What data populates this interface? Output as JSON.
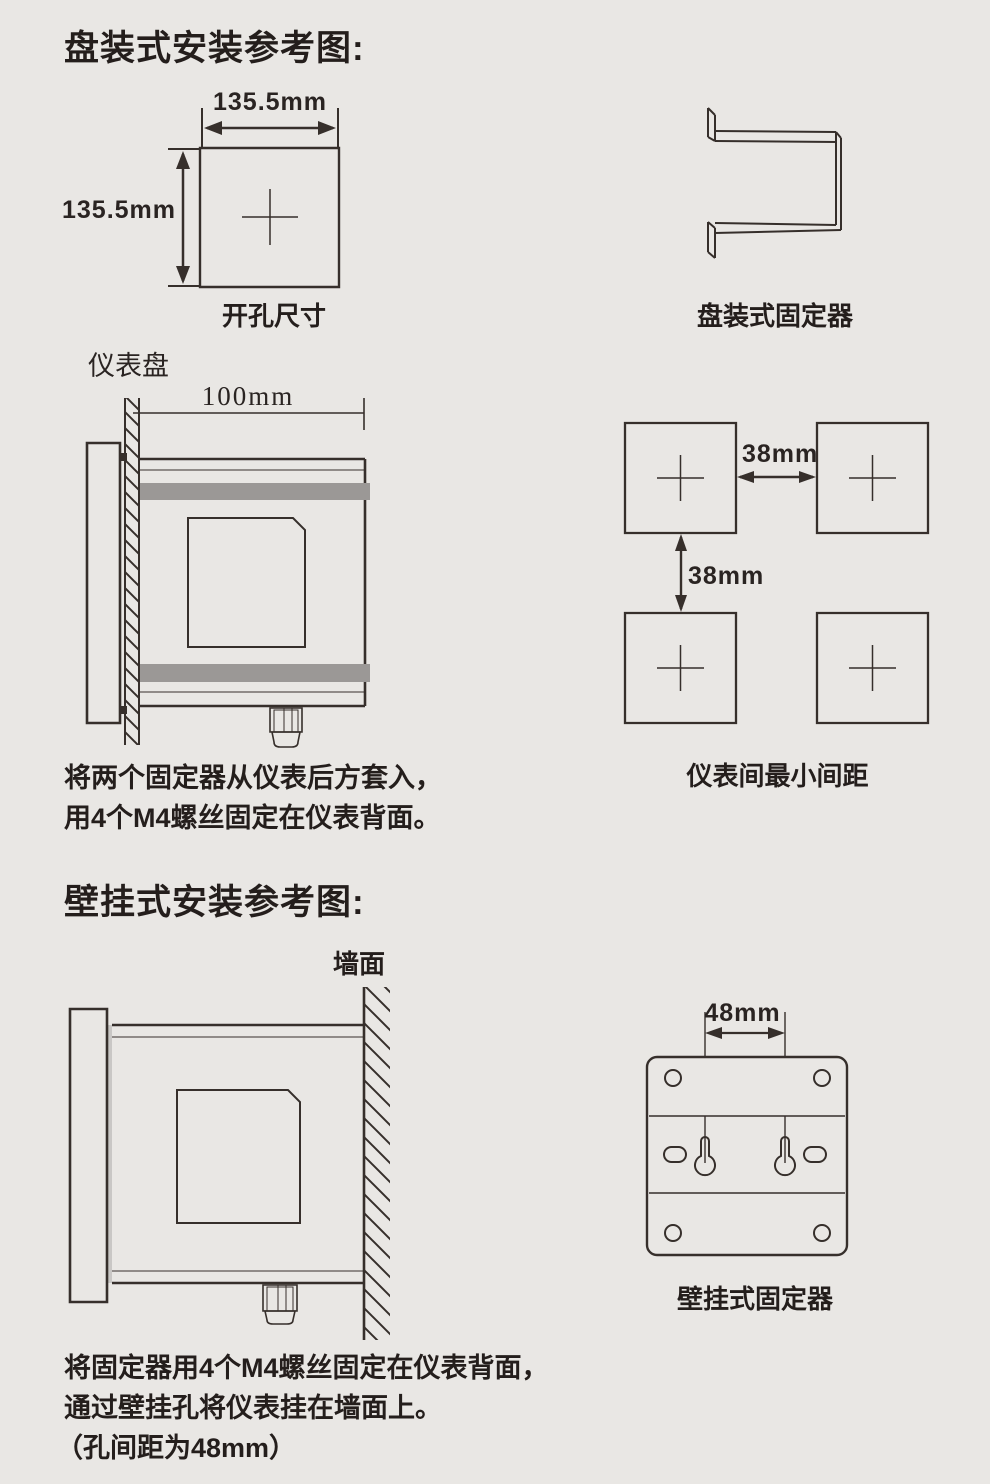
{
  "colors": {
    "background": "#e9e7e4",
    "line": "#362f2b",
    "text": "#241e1c",
    "gray_bar": "#9b9896"
  },
  "panel_section": {
    "title": "盘装式安装参考图:",
    "cutout": {
      "width_label": "135.5mm",
      "height_label": "135.5mm",
      "caption": "开孔尺寸"
    },
    "fixer_caption": "盘装式固定器",
    "side_view": {
      "panel_label": "仪表盘",
      "depth_label": "100mm"
    },
    "spacing": {
      "horizontal_gap_label": "38mm",
      "vertical_gap_label": "38mm",
      "caption": "仪表间最小间距"
    },
    "note": {
      "line1": "将两个固定器从仪表后方套入，",
      "line2": "用4个M4螺丝固定在仪表背面。"
    }
  },
  "wall_section": {
    "title": "壁挂式安装参考图:",
    "side_view": {
      "wall_label": "墙面"
    },
    "fixer": {
      "hole_spacing_label": "48mm",
      "caption": "壁挂式固定器"
    },
    "note": {
      "line1": "将固定器用4个M4螺丝固定在仪表背面，",
      "line2": "通过壁挂孔将仪表挂在墙面上。",
      "line3": "（孔间距为48mm）"
    }
  }
}
